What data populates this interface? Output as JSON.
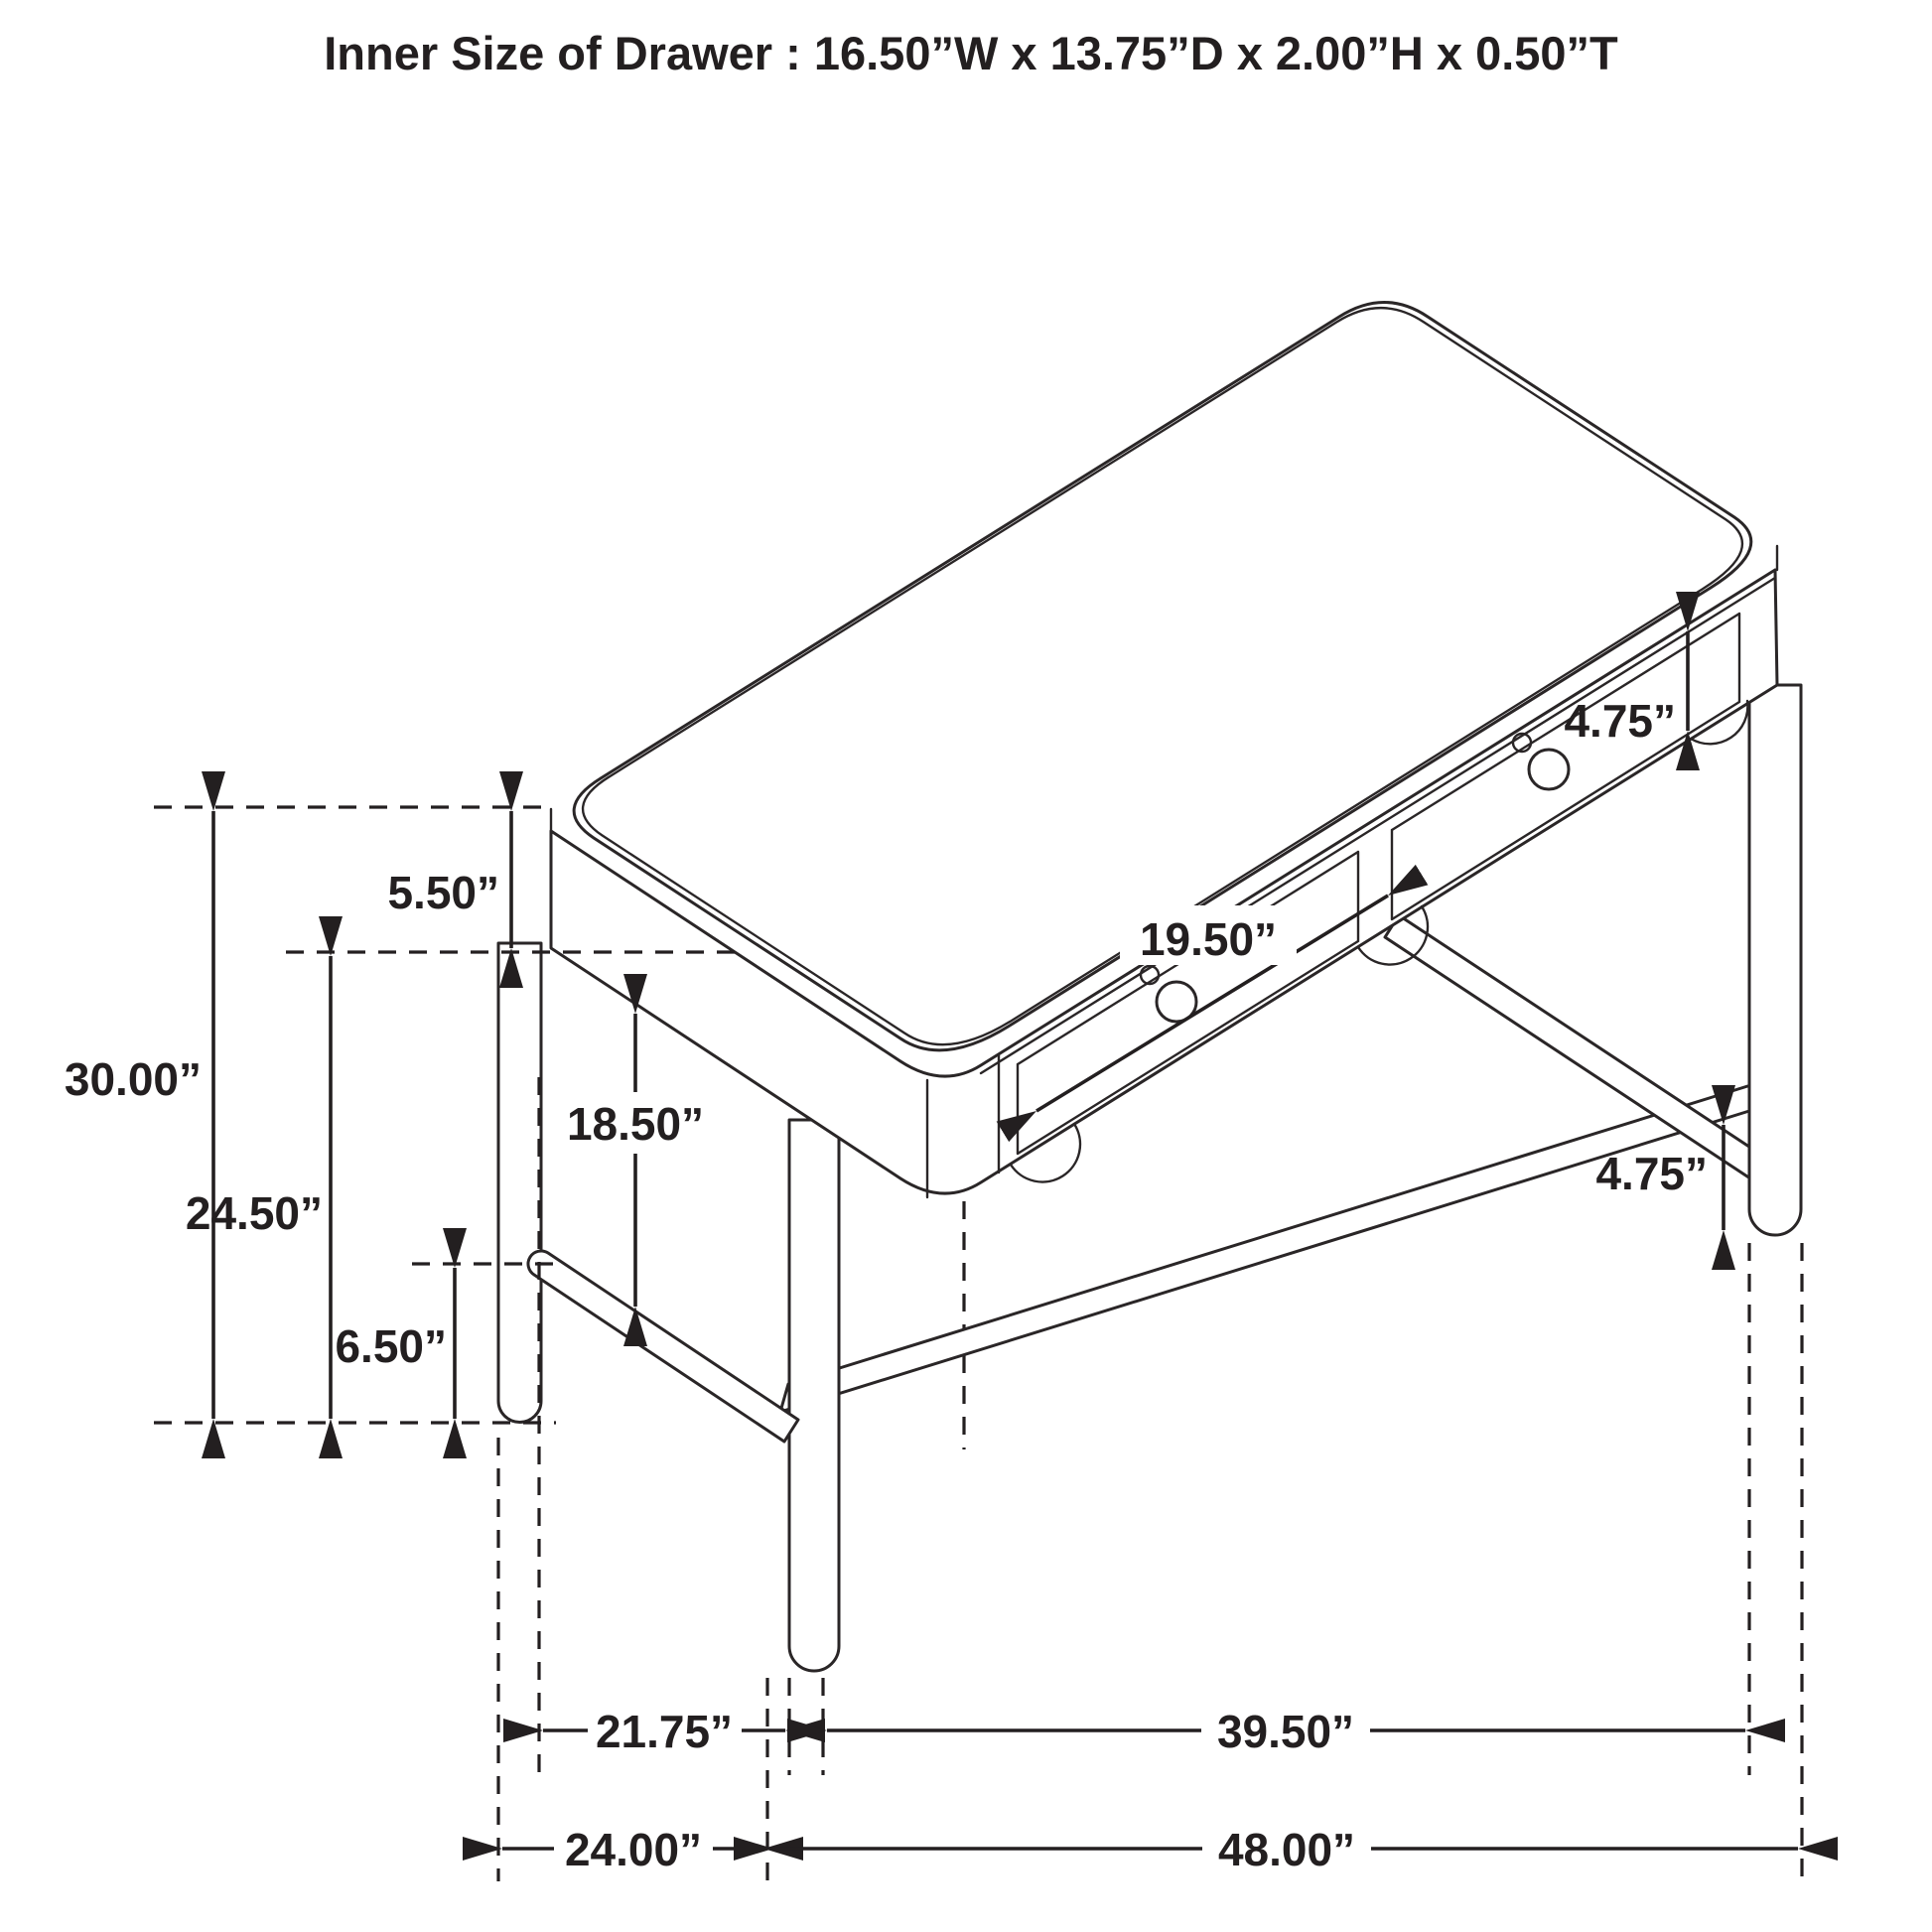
{
  "title": "Inner Size of Drawer : 16.50”W x 13.75”D x 2.00”H x 0.50”T",
  "diagram_type": "furniture dimension drawing (writing desk with two drawers)",
  "colors": {
    "line": "#231f20",
    "background": "#ffffff"
  },
  "dimensions": {
    "overall_height": "30.00”",
    "floor_to_apron_clearance": "24.50”",
    "top_and_apron_height": "5.50”",
    "stretcher_to_floor": "6.50”",
    "apron_to_stretcher": "18.50”",
    "drawer_front_width": "19.50”",
    "drawer_front_height": "4.75”",
    "leg_below_stretcher": "4.75”",
    "inner_leg_span_depth": "21.75”",
    "inner_leg_span_width": "39.50”",
    "overall_depth": "24.00”",
    "overall_width": "48.00”"
  }
}
